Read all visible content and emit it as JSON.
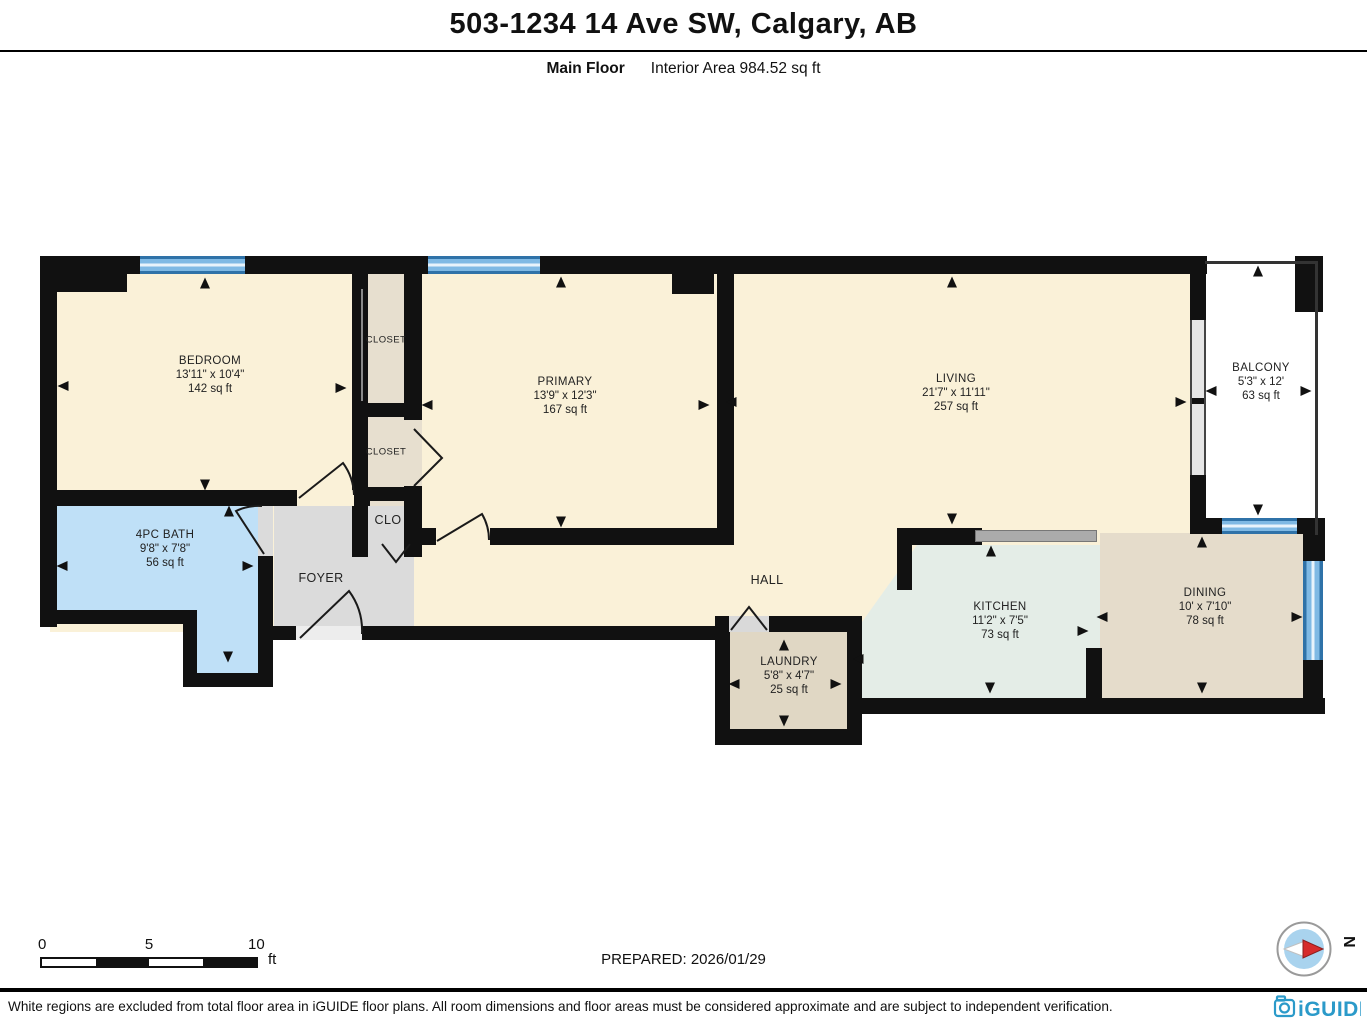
{
  "header": {
    "title": "503-1234 14 Ave SW, Calgary, AB",
    "floor_label": "Main Floor",
    "area_label": "Interior Area 984.52 sq ft"
  },
  "rooms": [
    {
      "id": "bedroom",
      "name": "BEDROOM",
      "dims": "13'11\" x 10'4\"",
      "area": "142 sq ft"
    },
    {
      "id": "closet1",
      "name": "CLOSET"
    },
    {
      "id": "closet2",
      "name": "CLOSET"
    },
    {
      "id": "clo",
      "name": "CLO"
    },
    {
      "id": "primary",
      "name": "PRIMARY",
      "dims": "13'9\" x 12'3\"",
      "area": "167 sq ft"
    },
    {
      "id": "living",
      "name": "LIVING",
      "dims": "21'7\" x 11'11\"",
      "area": "257 sq ft"
    },
    {
      "id": "balcony",
      "name": "BALCONY",
      "dims": "5'3\" x 12'",
      "area": "63 sq ft"
    },
    {
      "id": "bath",
      "name": "4PC BATH",
      "dims": "9'8\" x 7'8\"",
      "area": "56 sq ft"
    },
    {
      "id": "foyer",
      "name": "FOYER"
    },
    {
      "id": "hall",
      "name": "HALL"
    },
    {
      "id": "laundry",
      "name": "LAUNDRY",
      "dims": "5'8\" x 4'7\"",
      "area": "25 sq ft"
    },
    {
      "id": "kitchen",
      "name": "KITCHEN",
      "dims": "11'2\" x 7'5\"",
      "area": "73 sq ft"
    },
    {
      "id": "dining",
      "name": "DINING",
      "dims": "10' x 7'10\"",
      "area": "78 sq ft"
    }
  ],
  "scale_bar": {
    "ticks": [
      "0",
      "5",
      "10"
    ],
    "unit": "ft"
  },
  "prepared_label": "PREPARED: 2026/01/29",
  "compass": {
    "north_label": "N"
  },
  "footer": {
    "disclaimer": "White regions are excluded from total floor area in iGUIDE floor plans. All room dimensions and floor areas must be considered approximate and are subject to independent verification.",
    "brand": "iGUIDE"
  },
  "colors": {
    "floor-cream": "#FAF1D8",
    "floor-closet": "#E7DFCF",
    "floor-bath": "#BFE0F7",
    "floor-foyer": "#DBDBDB",
    "floor-kitchen": "#E4EDE7",
    "floor-laundry": "#E0D7C4",
    "floor-dining": "#E5DCCB",
    "floor-balcony": "#FFFFFF",
    "wall": "#111111",
    "window-blue": "#7FB9E4",
    "window-frame": "#2F72A8",
    "counter-gray": "#ABABAB",
    "brand-teal": "#2B9AC9",
    "compass-red": "#D62B2B",
    "compass-blue": "#A9D3EE"
  }
}
